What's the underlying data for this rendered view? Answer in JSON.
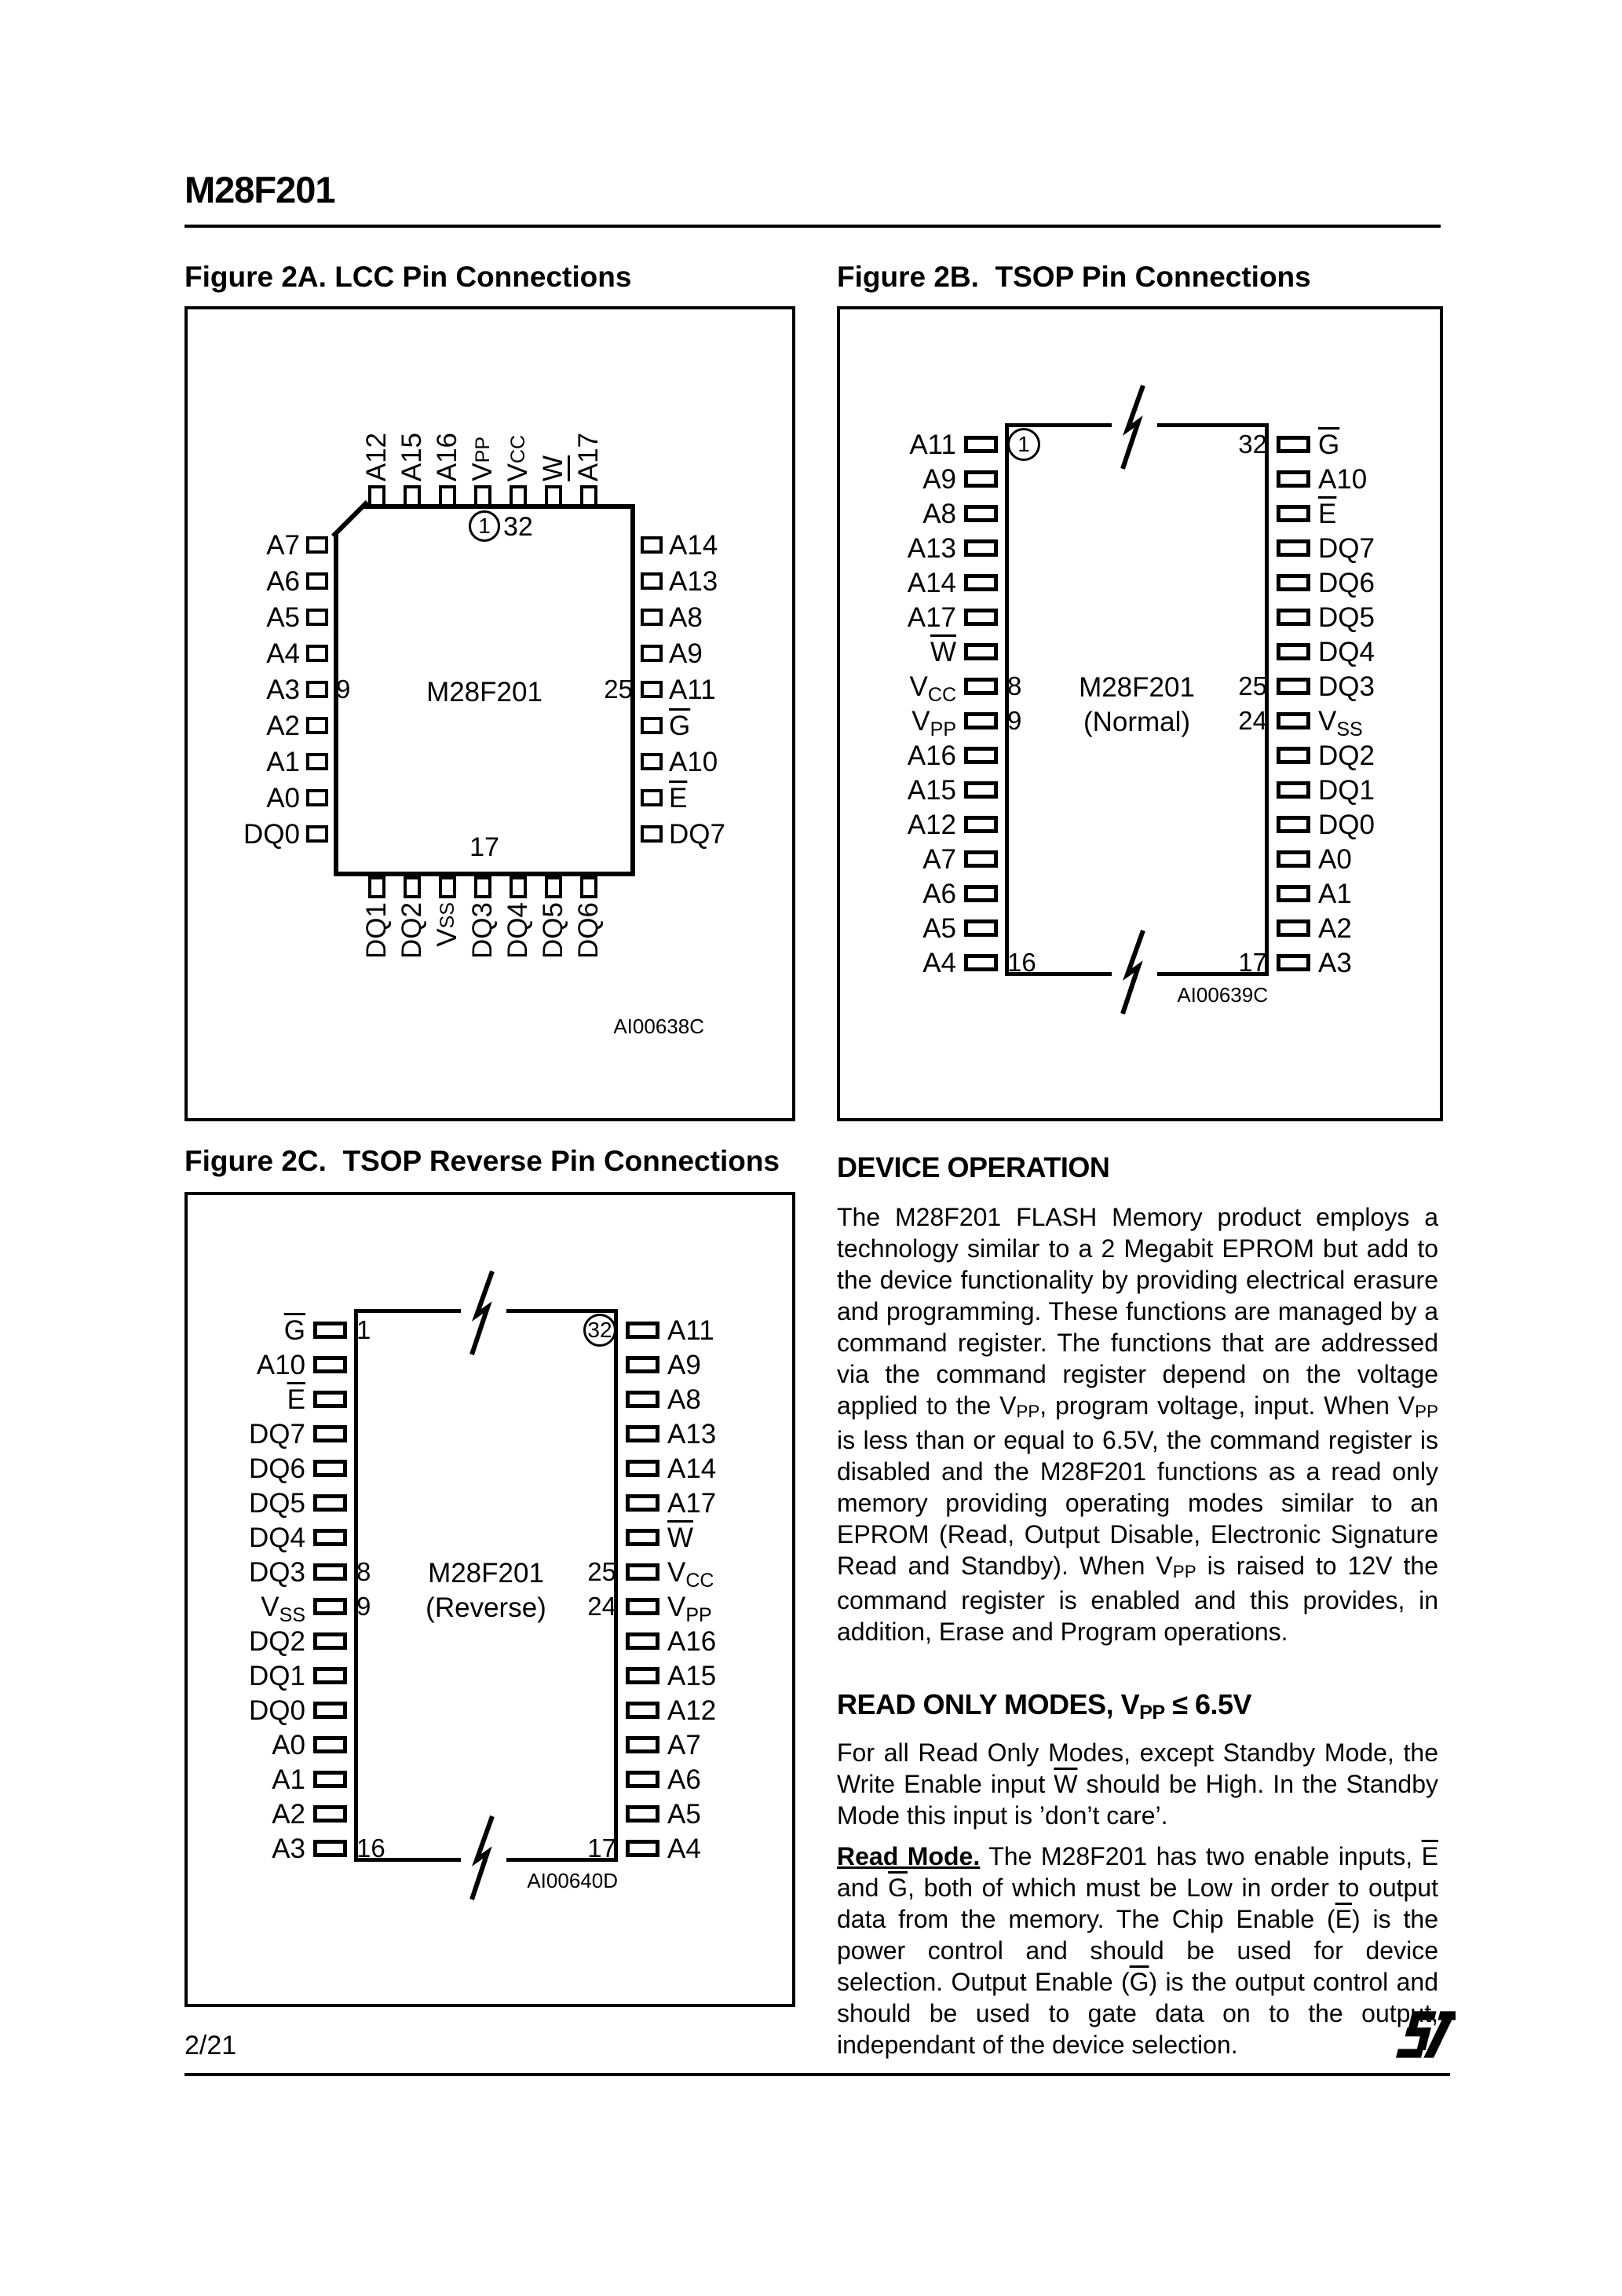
{
  "page": {
    "header_title": "M28F201",
    "page_number": "2/21",
    "logo_icon": "st-logo"
  },
  "fig2a": {
    "title": "Figure 2A. LCC Pin Connections",
    "chip_label": "M28F201",
    "pin1_num": "1",
    "pin1_side_num": "32",
    "bottom_inner_num": "17",
    "ref_code": "AI00638C",
    "top_pins": [
      {
        "t": "A12"
      },
      {
        "t": "A15"
      },
      {
        "t": "A16"
      },
      {
        "t": "V",
        "sub": "PP"
      },
      {
        "t": "V",
        "sub": "CC"
      },
      {
        "t": "W",
        "bar": true
      },
      {
        "t": "A17"
      }
    ],
    "left_pins": [
      {
        "t": "A7"
      },
      {
        "t": "A6"
      },
      {
        "t": "A5"
      },
      {
        "t": "A4"
      },
      {
        "t": "A3",
        "num": "9"
      },
      {
        "t": "A2"
      },
      {
        "t": "A1"
      },
      {
        "t": "A0"
      },
      {
        "t": "DQ0"
      }
    ],
    "right_pins": [
      {
        "t": "A14"
      },
      {
        "t": "A13"
      },
      {
        "t": "A8"
      },
      {
        "t": "A9"
      },
      {
        "t": "A11",
        "num": "25"
      },
      {
        "t": "G",
        "bar": true
      },
      {
        "t": "A10"
      },
      {
        "t": "E",
        "bar": true
      },
      {
        "t": "DQ7"
      }
    ],
    "bottom_pins": [
      {
        "t": "DQ1"
      },
      {
        "t": "DQ2"
      },
      {
        "t": "V",
        "sub": "SS"
      },
      {
        "t": "DQ3"
      },
      {
        "t": "DQ4"
      },
      {
        "t": "DQ5"
      },
      {
        "t": "DQ6"
      }
    ]
  },
  "fig2b": {
    "title": "Figure 2B.  TSOP Pin Connections",
    "chip_label": "M28F201",
    "chip_variant": "(Normal)",
    "ref_code": "AI00639C",
    "left_pins": [
      {
        "t": "A11",
        "num": "1",
        "circled": true
      },
      {
        "t": "A9"
      },
      {
        "t": "A8"
      },
      {
        "t": "A13"
      },
      {
        "t": "A14"
      },
      {
        "t": "A17"
      },
      {
        "t": "W",
        "bar": true
      },
      {
        "t": "V",
        "sub": "CC",
        "num": "8"
      },
      {
        "t": "V",
        "sub": "PP",
        "num": "9"
      },
      {
        "t": "A16"
      },
      {
        "t": "A15"
      },
      {
        "t": "A12"
      },
      {
        "t": "A7"
      },
      {
        "t": "A6"
      },
      {
        "t": "A5"
      },
      {
        "t": "A4",
        "num": "16"
      }
    ],
    "right_pins": [
      {
        "t": "G",
        "bar": true,
        "num": "32"
      },
      {
        "t": "A10"
      },
      {
        "t": "E",
        "bar": true
      },
      {
        "t": "DQ7"
      },
      {
        "t": "DQ6"
      },
      {
        "t": "DQ5"
      },
      {
        "t": "DQ4"
      },
      {
        "t": "DQ3",
        "num": "25"
      },
      {
        "t": "V",
        "sub": "SS",
        "num": "24"
      },
      {
        "t": "DQ2"
      },
      {
        "t": "DQ1"
      },
      {
        "t": "DQ0"
      },
      {
        "t": "A0"
      },
      {
        "t": "A1"
      },
      {
        "t": "A2"
      },
      {
        "t": "A3",
        "num": "17"
      }
    ]
  },
  "fig2c": {
    "title": "Figure 2C.  TSOP Reverse Pin Connections",
    "chip_label": "M28F201",
    "chip_variant": "(Reverse)",
    "ref_code": "AI00640D",
    "left_pins": [
      {
        "t": "G",
        "bar": true,
        "num": "1"
      },
      {
        "t": "A10"
      },
      {
        "t": "E",
        "bar": true
      },
      {
        "t": "DQ7"
      },
      {
        "t": "DQ6"
      },
      {
        "t": "DQ5"
      },
      {
        "t": "DQ4"
      },
      {
        "t": "DQ3",
        "num": "8"
      },
      {
        "t": "V",
        "sub": "SS",
        "num": "9"
      },
      {
        "t": "DQ2"
      },
      {
        "t": "DQ1"
      },
      {
        "t": "DQ0"
      },
      {
        "t": "A0"
      },
      {
        "t": "A1"
      },
      {
        "t": "A2"
      },
      {
        "t": "A3",
        "num": "16"
      }
    ],
    "right_pins": [
      {
        "t": "A11",
        "num": "32",
        "circled": true
      },
      {
        "t": "A9"
      },
      {
        "t": "A8"
      },
      {
        "t": "A13"
      },
      {
        "t": "A14"
      },
      {
        "t": "A17"
      },
      {
        "t": "W",
        "bar": true
      },
      {
        "t": "V",
        "sub": "CC",
        "num": "25"
      },
      {
        "t": "V",
        "sub": "PP",
        "num": "24"
      },
      {
        "t": "A16"
      },
      {
        "t": "A15"
      },
      {
        "t": "A12"
      },
      {
        "t": "A7"
      },
      {
        "t": "A6"
      },
      {
        "t": "A5"
      },
      {
        "t": "A4",
        "num": "17"
      }
    ]
  },
  "device_operation": {
    "heading": "DEVICE OPERATION",
    "para1": [
      {
        "t": "The M28F201 FLASH Memory product employs a technology similar to a 2 Megabit EPROM but add to the device functionality by providing electrical erasure and programming. These functions are managed by a command register. The functions that are addressed via the command register depend on the voltage applied to the V"
      },
      {
        "t": "PP",
        "sub": true
      },
      {
        "t": ", program voltage, input. When V"
      },
      {
        "t": "PP",
        "sub": true
      },
      {
        "t": " is less than or equal to 6.5V, the command register is disabled and the M28F201 functions as a read only memory providing operating modes similar to an EPROM (Read, Output Disable, Electronic Signature Read and Standby). When V"
      },
      {
        "t": "PP",
        "sub": true
      },
      {
        "t": " is raised to 12V the command register is enabled and this provides, in addition, Erase and Program operations."
      }
    ],
    "read_only_heading": [
      {
        "t": "READ ONLY MODES, V"
      },
      {
        "t": "PP",
        "sub": true
      },
      {
        "t": " ≤ 6.5V"
      }
    ],
    "para2": [
      {
        "t": "For all Read Only Modes, except Standby Mode, the Write Enable input "
      },
      {
        "t": "W",
        "bar": true
      },
      {
        "t": " should be High. In the Standby Mode this input is ’don’t care’."
      }
    ],
    "para3": [
      {
        "t": "Read Mode.",
        "bold": true,
        "underline": true
      },
      {
        "t": " The M28F201 has two enable inputs, "
      },
      {
        "t": "E",
        "bar": true
      },
      {
        "t": " and "
      },
      {
        "t": "G",
        "bar": true
      },
      {
        "t": ", both of which must be Low in order to output data from the memory. The Chip Enable ("
      },
      {
        "t": "E",
        "bar": true
      },
      {
        "t": ") is the power control and should be used for device selection. Output Enable ("
      },
      {
        "t": "G",
        "bar": true
      },
      {
        "t": ") is the output control and should be used to gate data on to the output, independant of the device selection."
      }
    ]
  }
}
